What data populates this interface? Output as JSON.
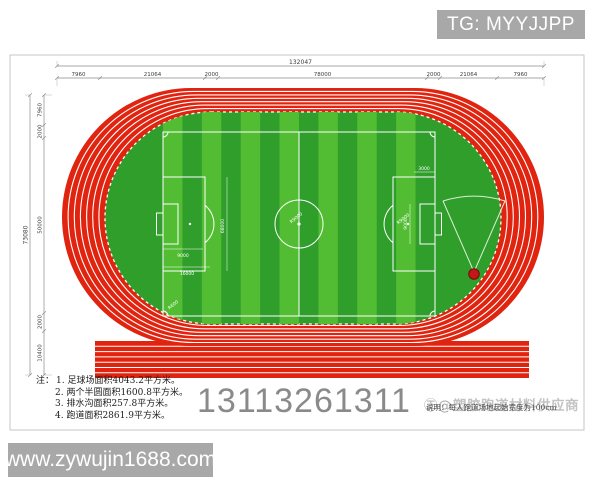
{
  "contact_banner": {
    "text": "TG: MYYJJPP"
  },
  "website_banner": {
    "text": "www.zywujin1688.com"
  },
  "phone_number": "13113261311",
  "notes": {
    "prefix": "注：",
    "lines": [
      "1. 足球场面积4043.2平方米。",
      "2. 两个半圆面积1600.8平方米。",
      "3. 排水沟面积257.8平方米。",
      "4. 跑道面积2861.9平方米。"
    ]
  },
  "watermark": {
    "logo": "㊣@",
    "brand": "塑胶跑道材料供应商",
    "note": "说明：每人跑道场地起始宽度为100cm"
  },
  "dimensions": {
    "top_total": "132047",
    "top_segments": [
      "7960",
      "21064",
      "2000",
      "78000",
      "2000",
      "21064",
      "7960"
    ],
    "left_total": "73080",
    "left_segments": [
      "7960",
      "2000",
      "50000",
      "2000",
      "10400"
    ]
  },
  "field_annotations": {
    "pitch_length": "68000",
    "center_radius": "R9000",
    "arc_radius": "R9000",
    "goal_width": "9000",
    "goal_area": "16000",
    "right_goal": "9000",
    "right_top": "3000",
    "corner_radius": "R600"
  },
  "colors": {
    "track_red": "#e0240f",
    "field_green": "#2f9e2b",
    "stripe_green": "#52bd33",
    "line_white": "#ffffff",
    "banner_gray": "#a8a8a8",
    "phone_gray": "#8a8a8a"
  }
}
